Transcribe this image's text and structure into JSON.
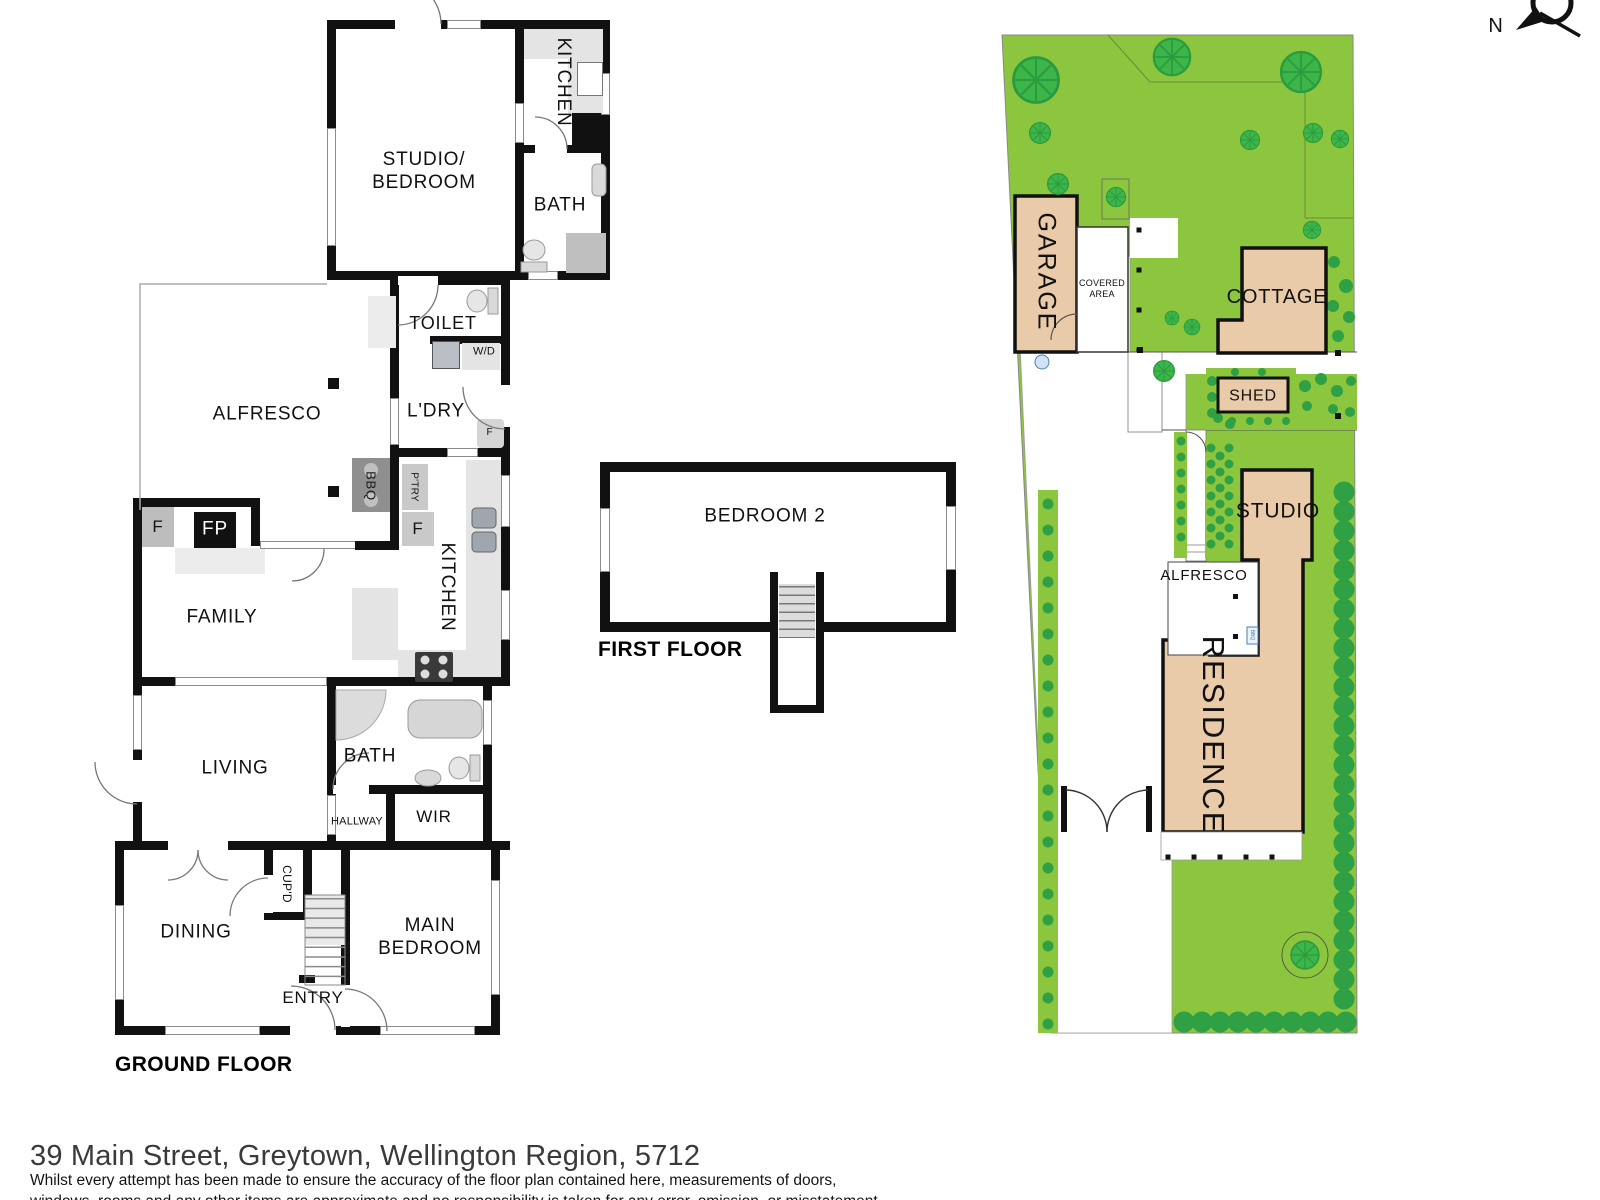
{
  "page": {
    "address": "39 Main Street, Greytown, Wellington Region, 5712",
    "disclaimer_line1": "Whilst every attempt has been made to ensure the accuracy of the floor plan contained here, measurements of doors,",
    "disclaimer_line2": "windows, rooms and any other items are approximate and no responsibility is taken for any error, omission, or misstatement."
  },
  "compass": {
    "north": "N"
  },
  "ground_floor": {
    "title": "GROUND FLOOR",
    "rooms": {
      "studio_bedroom": "STUDIO/\nBEDROOM",
      "kitchen_studio": "KITCHEN",
      "bath_studio": "BATH",
      "toilet": "TOILET",
      "wd": "W/D",
      "ldry": "L'DRY",
      "alfresco": "ALFRESCO",
      "bbq": "BBQ",
      "ptry": "P'TRY",
      "f": "F",
      "fp": "FP",
      "family": "FAMILY",
      "kitchen": "KITCHEN",
      "living": "LIVING",
      "bath": "BATH",
      "hallway": "HALLWAY",
      "wir": "WIR",
      "dining": "DINING",
      "cupd": "CUP'D",
      "entry": "ENTRY",
      "main_bedroom": "MAIN\nBEDROOM"
    }
  },
  "first_floor": {
    "title": "FIRST FLOOR",
    "rooms": {
      "bedroom2": "BEDROOM 2"
    }
  },
  "site_plan": {
    "labels": {
      "garage": "GARAGE",
      "covered_area": "COVERED\nAREA",
      "cottage": "COTTAGE",
      "shed": "SHED",
      "studio": "STUDIO",
      "alfresco": "ALFRESCO",
      "residence": "RESIDENCE",
      "bbq": "BBQ"
    }
  },
  "colors": {
    "wall": "#111111",
    "lawn": "#8CC63F",
    "tree": "#3CB549",
    "hedge": "#2FA043",
    "building_fill": "#E9CBA9",
    "fixture_gray": "#E4E4E4"
  }
}
